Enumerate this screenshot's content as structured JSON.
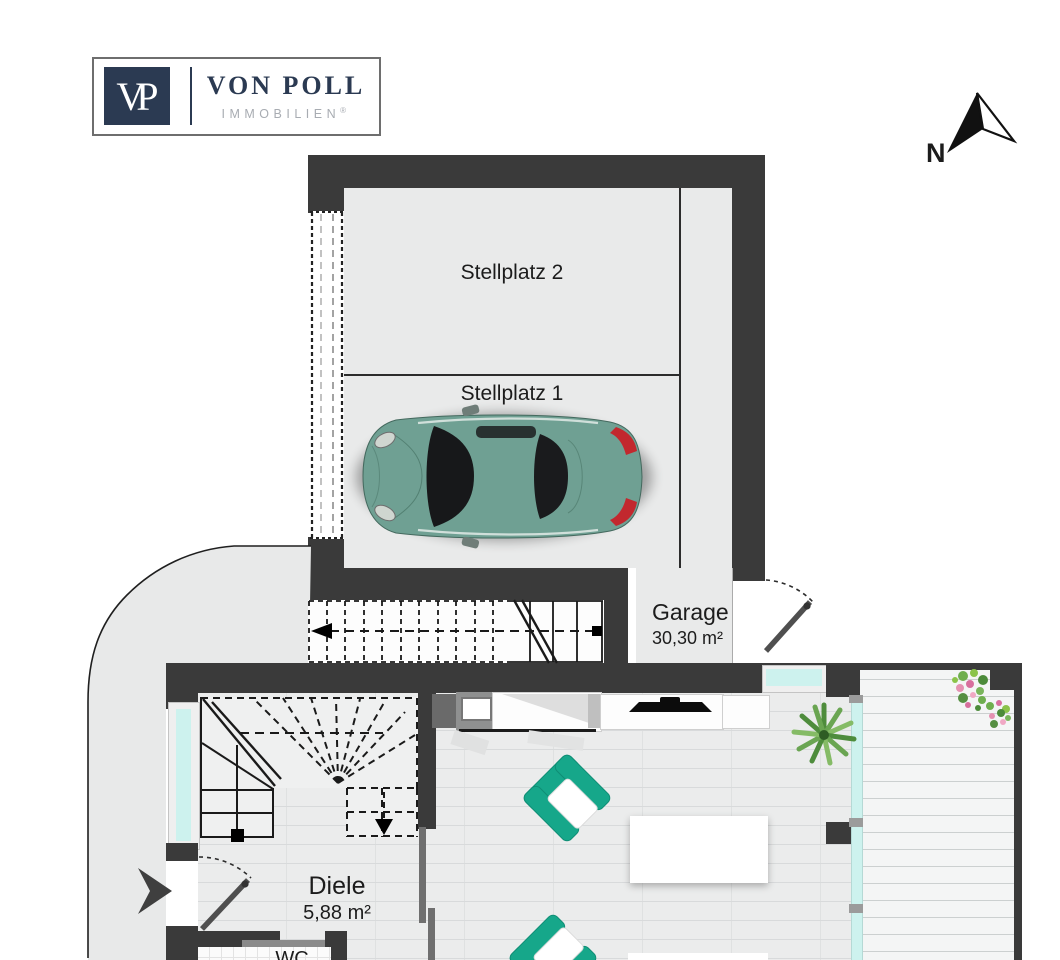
{
  "branding": {
    "logo_monogram": "VP",
    "logo_name": "VON POLL",
    "logo_subtitle": "IMMOBILIEN",
    "logo_registered": "®"
  },
  "compass": {
    "north_label": "N"
  },
  "rooms": {
    "stellplatz2": {
      "label": "Stellplatz 2"
    },
    "stellplatz1": {
      "label": "Stellplatz 1"
    },
    "garage": {
      "label": "Garage",
      "area": "30,30 m²"
    },
    "diele": {
      "label": "Diele",
      "area": "5,88 m²"
    },
    "wc": {
      "label": "WC"
    }
  },
  "colors": {
    "wall": "#3a3a3a",
    "floor": "#e8e9e9",
    "wood": "#ebecec",
    "deck": "#f4f5f5",
    "glass": "#cdf2ee",
    "teal": "#16a78a",
    "car_body": "#6fa093",
    "taillight_red": "#c2282e",
    "logo_navy": "#2b3a52",
    "logo_gray": "#a8acb2",
    "line_dark": "#1f1f1f"
  }
}
